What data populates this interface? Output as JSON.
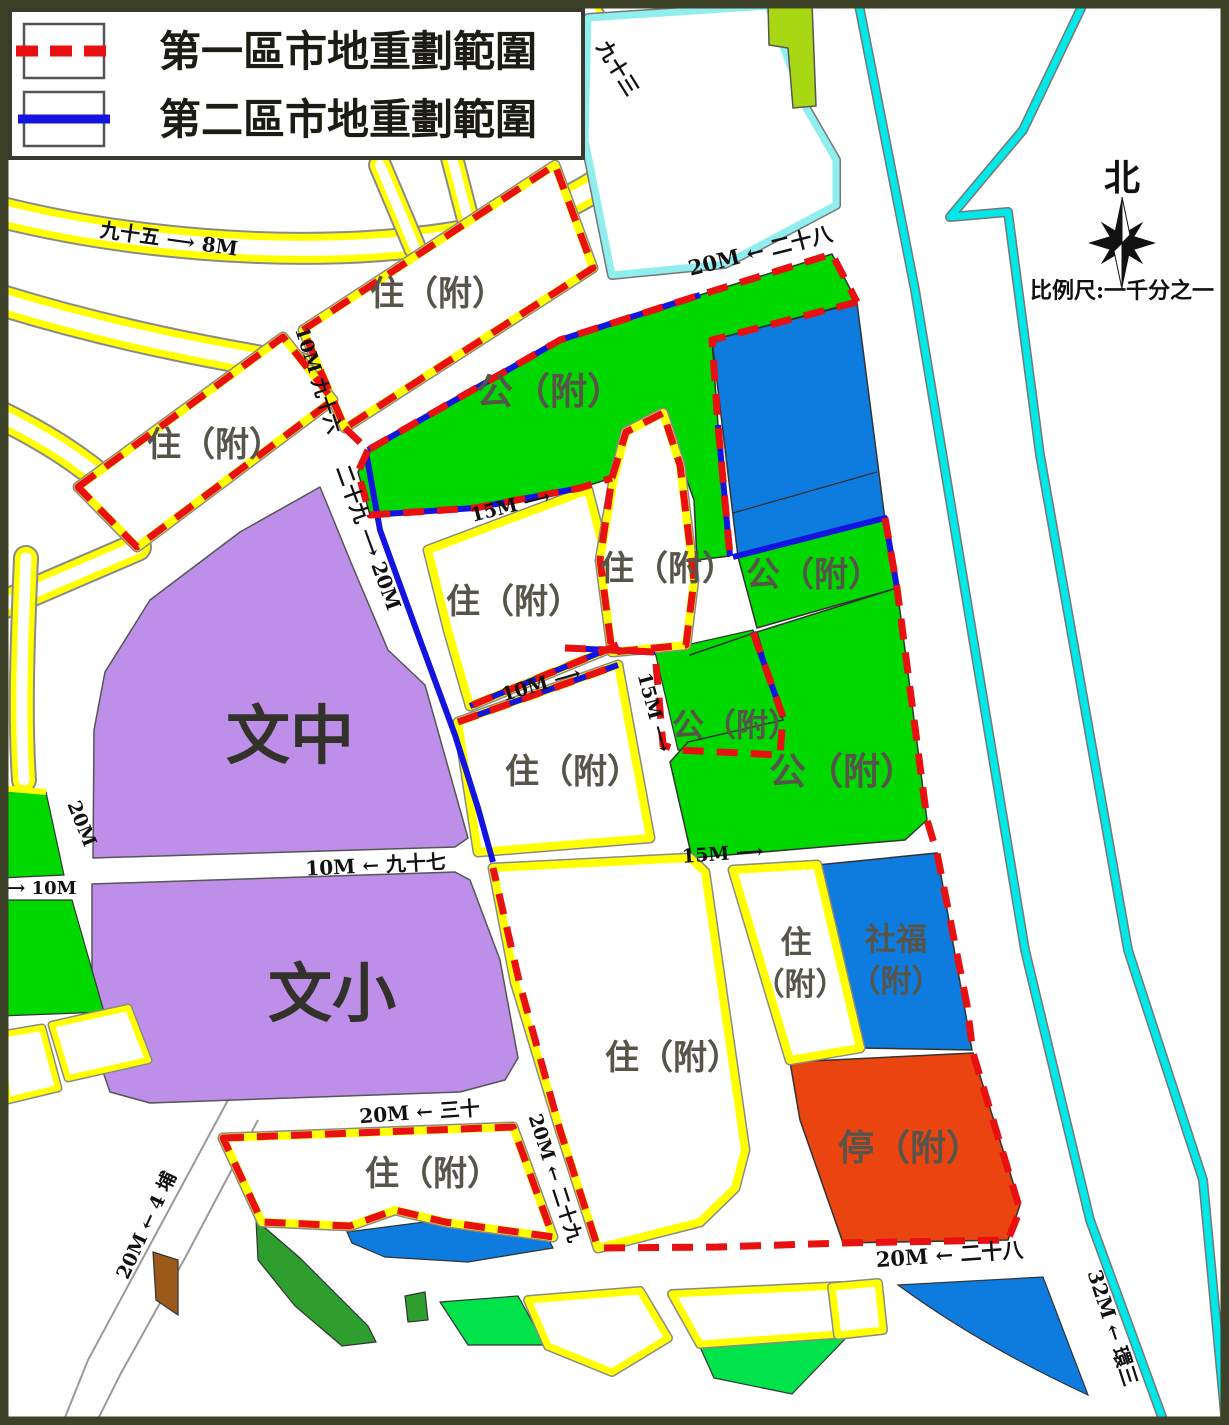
{
  "legend": {
    "items": [
      {
        "label": "第一區市地重劃範圍",
        "line_color": "#E81010",
        "line_style": "dashed"
      },
      {
        "label": "第二區市地重劃範圍",
        "line_color": "#1414E0",
        "line_style": "solid"
      }
    ]
  },
  "compass": {
    "label": "北"
  },
  "scale_text": "比例尺:一千分之一",
  "zones": {
    "labels": [
      {
        "text": "住（附）",
        "kind": "residential"
      },
      {
        "text": "住（附）",
        "kind": "residential"
      },
      {
        "text": "公（附）",
        "kind": "public"
      },
      {
        "text": "住（附）",
        "kind": "residential"
      },
      {
        "text": "公（附）",
        "kind": "public"
      },
      {
        "text": "住（附）",
        "kind": "residential"
      },
      {
        "text": "住（附）",
        "kind": "residential"
      },
      {
        "text": "公（附）",
        "kind": "public"
      },
      {
        "text": "公（附）",
        "kind": "public"
      },
      {
        "text": "文中",
        "kind": "junior-high-school"
      },
      {
        "text": "文小",
        "kind": "elementary-school"
      },
      {
        "text": "住",
        "kind": "residential"
      },
      {
        "text": "（附）",
        "kind": "residential"
      },
      {
        "text": "社福",
        "kind": "social-welfare"
      },
      {
        "text": "（附）",
        "kind": "social-welfare"
      },
      {
        "text": "停（附）",
        "kind": "parking"
      },
      {
        "text": "住（附）",
        "kind": "residential"
      },
      {
        "text": "住（附）",
        "kind": "residential"
      }
    ]
  },
  "road_labels": [
    {
      "text": "九十五 ⟶ 8M"
    },
    {
      "text": "九十三"
    },
    {
      "text": "20M ← 二十八"
    },
    {
      "text": "10M 九十六"
    },
    {
      "text": "二十九 ⟶ 20M"
    },
    {
      "text": "15M ⟶"
    },
    {
      "text": "10M ⟶"
    },
    {
      "text": "15M ⟶"
    },
    {
      "text": "15M ⟶"
    },
    {
      "text": "10M ← 九十七"
    },
    {
      "text": "⟶ 10M"
    },
    {
      "text": "20M"
    },
    {
      "text": "20M ← 三十"
    },
    {
      "text": "20M ← 二十九"
    },
    {
      "text": "20M ← 4 埔"
    },
    {
      "text": "20M ← 二十八"
    },
    {
      "text": "32M ← 環三"
    }
  ],
  "colors": {
    "district1_boundary": "#E81010",
    "district2_boundary": "#1414E0",
    "parcel_border_yellow": "#FFFF00",
    "public_green": "#00D800",
    "school_purple": "#BE8FE8",
    "facility_blue": "#0E7BDF",
    "parking_orange": "#EA4411",
    "river_cyan": "#00E8E8",
    "pale_cyan": "#90EEEE",
    "lime_green": "#A8D814",
    "dark_green": "#2E9E2E",
    "bright_green": "#00E34A",
    "brown": "#9C5A1A",
    "map_frame": "#3E4228"
  }
}
